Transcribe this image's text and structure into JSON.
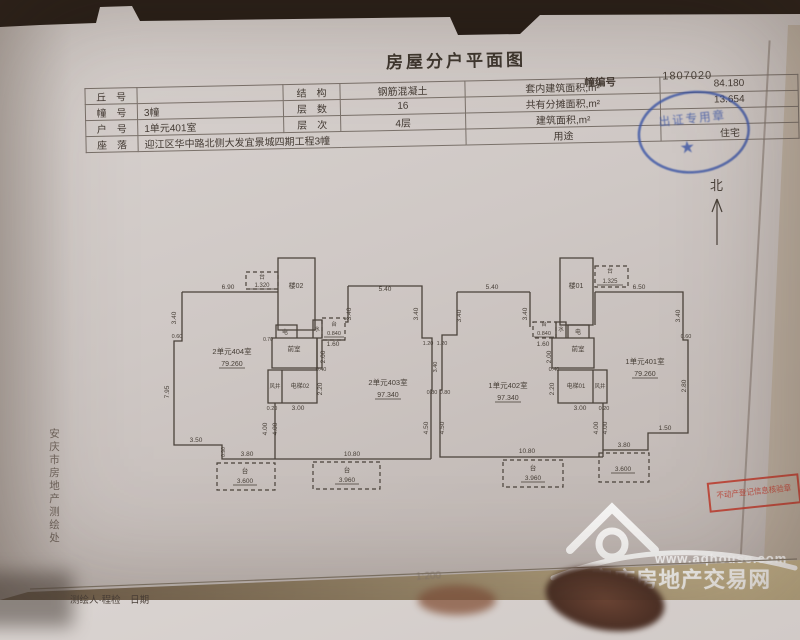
{
  "colors": {
    "paper": "#cfc8c5",
    "ink": "#4a423a",
    "stamp_blue": "#3b55a6",
    "stamp_red": "#c0392b",
    "watermark": "#ffffff"
  },
  "title": "房屋分户平面图",
  "building_no": {
    "label": "幢编号",
    "value": "1807020"
  },
  "info_table": {
    "rows": [
      {
        "c1": "丘　号",
        "c2": "",
        "c3": "结　构",
        "c4": "钢筋混凝土",
        "c5": "套内建筑面积,m²",
        "c6": "84.180"
      },
      {
        "c1": "幢　号",
        "c2": "3幢",
        "c3": "层　数",
        "c4": "16",
        "c5": "共有分摊面积,m²",
        "c6": "13.654"
      },
      {
        "c1": "户　号",
        "c2": "1单元401室",
        "c3": "层　次",
        "c4": "4层",
        "c5": "建筑面积,m²",
        "c6": ""
      },
      {
        "c1": "座　落",
        "c2": "迎江区华中路北侧大发宜景城四期工程3幢",
        "c5": "用途",
        "c6": "住宅"
      }
    ]
  },
  "north": {
    "label": "北"
  },
  "plan": {
    "scale_text": "1:200",
    "labels": [
      {
        "t": "台",
        "x": 262,
        "y": 279,
        "s": 6
      },
      {
        "t": "1.320",
        "x": 262,
        "y": 287,
        "u": 26,
        "s": 6
      },
      {
        "t": "楼02",
        "x": 296,
        "y": 288,
        "s": 7
      },
      {
        "t": "6.90",
        "x": 228,
        "y": 289
      },
      {
        "t": "3.40",
        "x": 176,
        "y": 318,
        "r": 1
      },
      {
        "t": "0.60",
        "x": 177,
        "y": 338,
        "s": 5.5
      },
      {
        "t": "7.95",
        "x": 169,
        "y": 392,
        "r": 1
      },
      {
        "t": "3.50",
        "x": 196,
        "y": 442
      },
      {
        "t": "0.90",
        "x": 225,
        "y": 452,
        "r": 1,
        "s": 5
      },
      {
        "t": "3.80",
        "x": 247,
        "y": 456
      },
      {
        "t": "10.80",
        "x": 352,
        "y": 456
      },
      {
        "t": "4.00",
        "x": 267,
        "y": 429,
        "r": 1
      },
      {
        "t": "4.00",
        "x": 277,
        "y": 429,
        "r": 1
      },
      {
        "t": "2单元404室",
        "x": 232,
        "y": 354,
        "s": 7.5
      },
      {
        "t": "79.260",
        "x": 232,
        "y": 366,
        "u": 26,
        "s": 7
      },
      {
        "t": "电",
        "x": 285,
        "y": 334,
        "s": 6
      },
      {
        "t": "0.70",
        "x": 268,
        "y": 341,
        "s": 5
      },
      {
        "t": "前室",
        "x": 294,
        "y": 351,
        "s": 6.5
      },
      {
        "t": "风井",
        "x": 275,
        "y": 388,
        "s": 5.5
      },
      {
        "t": "电梯02",
        "x": 300,
        "y": 388,
        "s": 6
      },
      {
        "t": "水",
        "x": 317,
        "y": 331,
        "s": 5.5
      },
      {
        "t": "台",
        "x": 334,
        "y": 326,
        "s": 5.5
      },
      {
        "t": "0.840",
        "x": 334,
        "y": 335,
        "u": 20,
        "s": 5.5
      },
      {
        "t": "1.60",
        "x": 333,
        "y": 346
      },
      {
        "t": "2.00",
        "x": 325,
        "y": 357,
        "r": 1
      },
      {
        "t": "0.40",
        "x": 321,
        "y": 371,
        "s": 5.5
      },
      {
        "t": "2.20",
        "x": 322,
        "y": 389,
        "r": 1
      },
      {
        "t": "0.20",
        "x": 272,
        "y": 410,
        "s": 5.5
      },
      {
        "t": "3.00",
        "x": 298,
        "y": 410
      },
      {
        "t": "5.40",
        "x": 385,
        "y": 291
      },
      {
        "t": "3.40",
        "x": 351,
        "y": 314,
        "r": 1
      },
      {
        "t": "2单元403室",
        "x": 388,
        "y": 385,
        "s": 7.5
      },
      {
        "t": "97.340",
        "x": 388,
        "y": 397,
        "u": 26,
        "s": 7
      },
      {
        "t": "3.40",
        "x": 418,
        "y": 314,
        "r": 1
      },
      {
        "t": "1.20",
        "x": 428,
        "y": 345,
        "s": 5.5
      },
      {
        "t": "1.20",
        "x": 442,
        "y": 345,
        "s": 5.5
      },
      {
        "t": "3.40",
        "x": 437,
        "y": 367,
        "r": 1,
        "s": 5.5
      },
      {
        "t": "0.80",
        "x": 432,
        "y": 394,
        "s": 5.5
      },
      {
        "t": "0.80",
        "x": 445,
        "y": 394,
        "s": 5.5
      },
      {
        "t": "4.50",
        "x": 428,
        "y": 428,
        "r": 1
      },
      {
        "t": "台",
        "x": 245,
        "y": 473,
        "s": 6.5
      },
      {
        "t": "3.600",
        "x": 245,
        "y": 483,
        "u": 24,
        "s": 6.5
      },
      {
        "t": "台",
        "x": 347,
        "y": 472,
        "s": 6.5
      },
      {
        "t": "3.960",
        "x": 347,
        "y": 482,
        "u": 24,
        "s": 6.5
      },
      {
        "t": "5.40",
        "x": 492,
        "y": 289
      },
      {
        "t": "3.40",
        "x": 461,
        "y": 316,
        "r": 1
      },
      {
        "t": "楼01",
        "x": 576,
        "y": 288,
        "s": 7
      },
      {
        "t": "台",
        "x": 610,
        "y": 273,
        "s": 6
      },
      {
        "t": "1.325",
        "x": 610,
        "y": 283,
        "u": 26,
        "s": 6
      },
      {
        "t": "6.50",
        "x": 639,
        "y": 289
      },
      {
        "t": "3.40",
        "x": 527,
        "y": 314,
        "r": 1
      },
      {
        "t": "电",
        "x": 578,
        "y": 334,
        "s": 6
      },
      {
        "t": "水",
        "x": 561,
        "y": 331,
        "s": 5.5
      },
      {
        "t": "台",
        "x": 544,
        "y": 326,
        "s": 5.5
      },
      {
        "t": "0.840",
        "x": 544,
        "y": 335,
        "u": 20,
        "s": 5.5
      },
      {
        "t": "1.60",
        "x": 543,
        "y": 346
      },
      {
        "t": "2.00",
        "x": 551,
        "y": 357,
        "r": 1
      },
      {
        "t": "0.40",
        "x": 554,
        "y": 371,
        "s": 5.5
      },
      {
        "t": "2.20",
        "x": 554,
        "y": 389,
        "r": 1
      },
      {
        "t": "前室",
        "x": 578,
        "y": 351,
        "s": 6.5
      },
      {
        "t": "电梯01",
        "x": 576,
        "y": 388,
        "s": 6
      },
      {
        "t": "风井",
        "x": 600,
        "y": 388,
        "s": 5.5
      },
      {
        "t": "3.00",
        "x": 580,
        "y": 410
      },
      {
        "t": "0.20",
        "x": 604,
        "y": 410,
        "s": 5.5
      },
      {
        "t": "1单元402室",
        "x": 508,
        "y": 388,
        "s": 7.5
      },
      {
        "t": "97.340",
        "x": 508,
        "y": 400,
        "u": 26,
        "s": 7
      },
      {
        "t": "1单元401室",
        "x": 645,
        "y": 364,
        "s": 7.5
      },
      {
        "t": "79.260",
        "x": 645,
        "y": 376,
        "u": 26,
        "s": 7
      },
      {
        "t": "3.40",
        "x": 680,
        "y": 316,
        "r": 1
      },
      {
        "t": "0.60",
        "x": 686,
        "y": 338,
        "s": 5.5
      },
      {
        "t": "2.80",
        "x": 686,
        "y": 386,
        "r": 1
      },
      {
        "t": "1.50",
        "x": 665,
        "y": 430
      },
      {
        "t": "3.80",
        "x": 624,
        "y": 447
      },
      {
        "t": "10.80",
        "x": 527,
        "y": 453
      },
      {
        "t": "4.00",
        "x": 598,
        "y": 428,
        "r": 1
      },
      {
        "t": "4.00",
        "x": 607,
        "y": 428,
        "r": 1
      },
      {
        "t": "4.50",
        "x": 444,
        "y": 428,
        "r": 1
      },
      {
        "t": "台",
        "x": 533,
        "y": 470,
        "s": 6.5
      },
      {
        "t": "3.960",
        "x": 533,
        "y": 480,
        "u": 24,
        "s": 6.5
      },
      {
        "t": "3.600",
        "x": 623,
        "y": 471,
        "u": 24,
        "s": 6.5
      }
    ]
  },
  "stamps": {
    "blue_text": "出证专用章",
    "red_text": "不动产登记信息核验章"
  },
  "watermark": {
    "url": "www.aqhouse.com",
    "name": "安庆房地产交易网"
  },
  "side_text": "安庆市房地产测绘处",
  "bottom_text": "测绘人·程检　日期",
  "scale_note": "1:200"
}
